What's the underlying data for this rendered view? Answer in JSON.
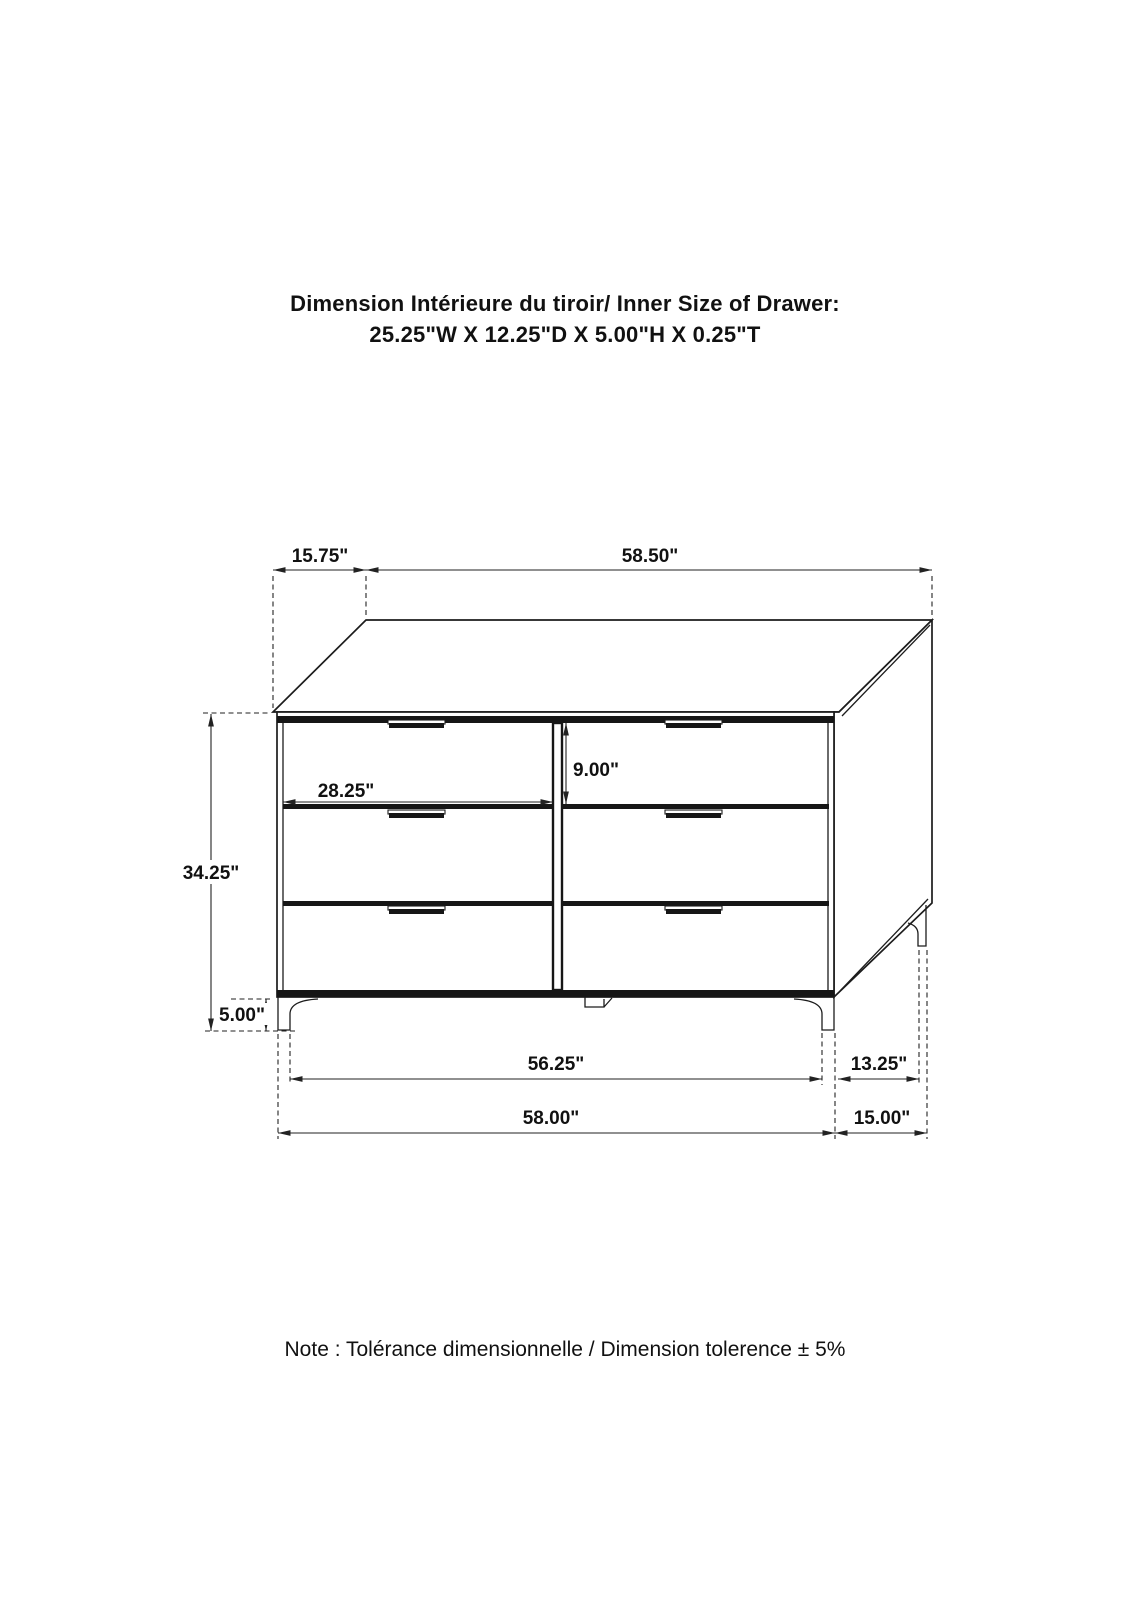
{
  "title": {
    "line1": "Dimension Intérieure du tiroir/ Inner Size of Drawer:",
    "line2": "25.25\"W X 12.25\"D X 5.00\"H X 0.25\"T"
  },
  "note": "Note : Tolérance dimensionnelle / Dimension tolerence  ± 5%",
  "dimensions": {
    "top_depth_offset": "15.75\"",
    "top_width": "58.50\"",
    "overall_height": "34.25\"",
    "leg_height": "5.00\"",
    "drawer_width": "28.25\"",
    "drawer_height": "9.00\"",
    "front_leg_span": "56.25\"",
    "base_width": "58.00\"",
    "side_leg_span": "13.25\"",
    "side_depth": "15.00\""
  },
  "colors": {
    "line": "#1c1c1c",
    "dimension_line": "#222222",
    "background": "#ffffff"
  }
}
